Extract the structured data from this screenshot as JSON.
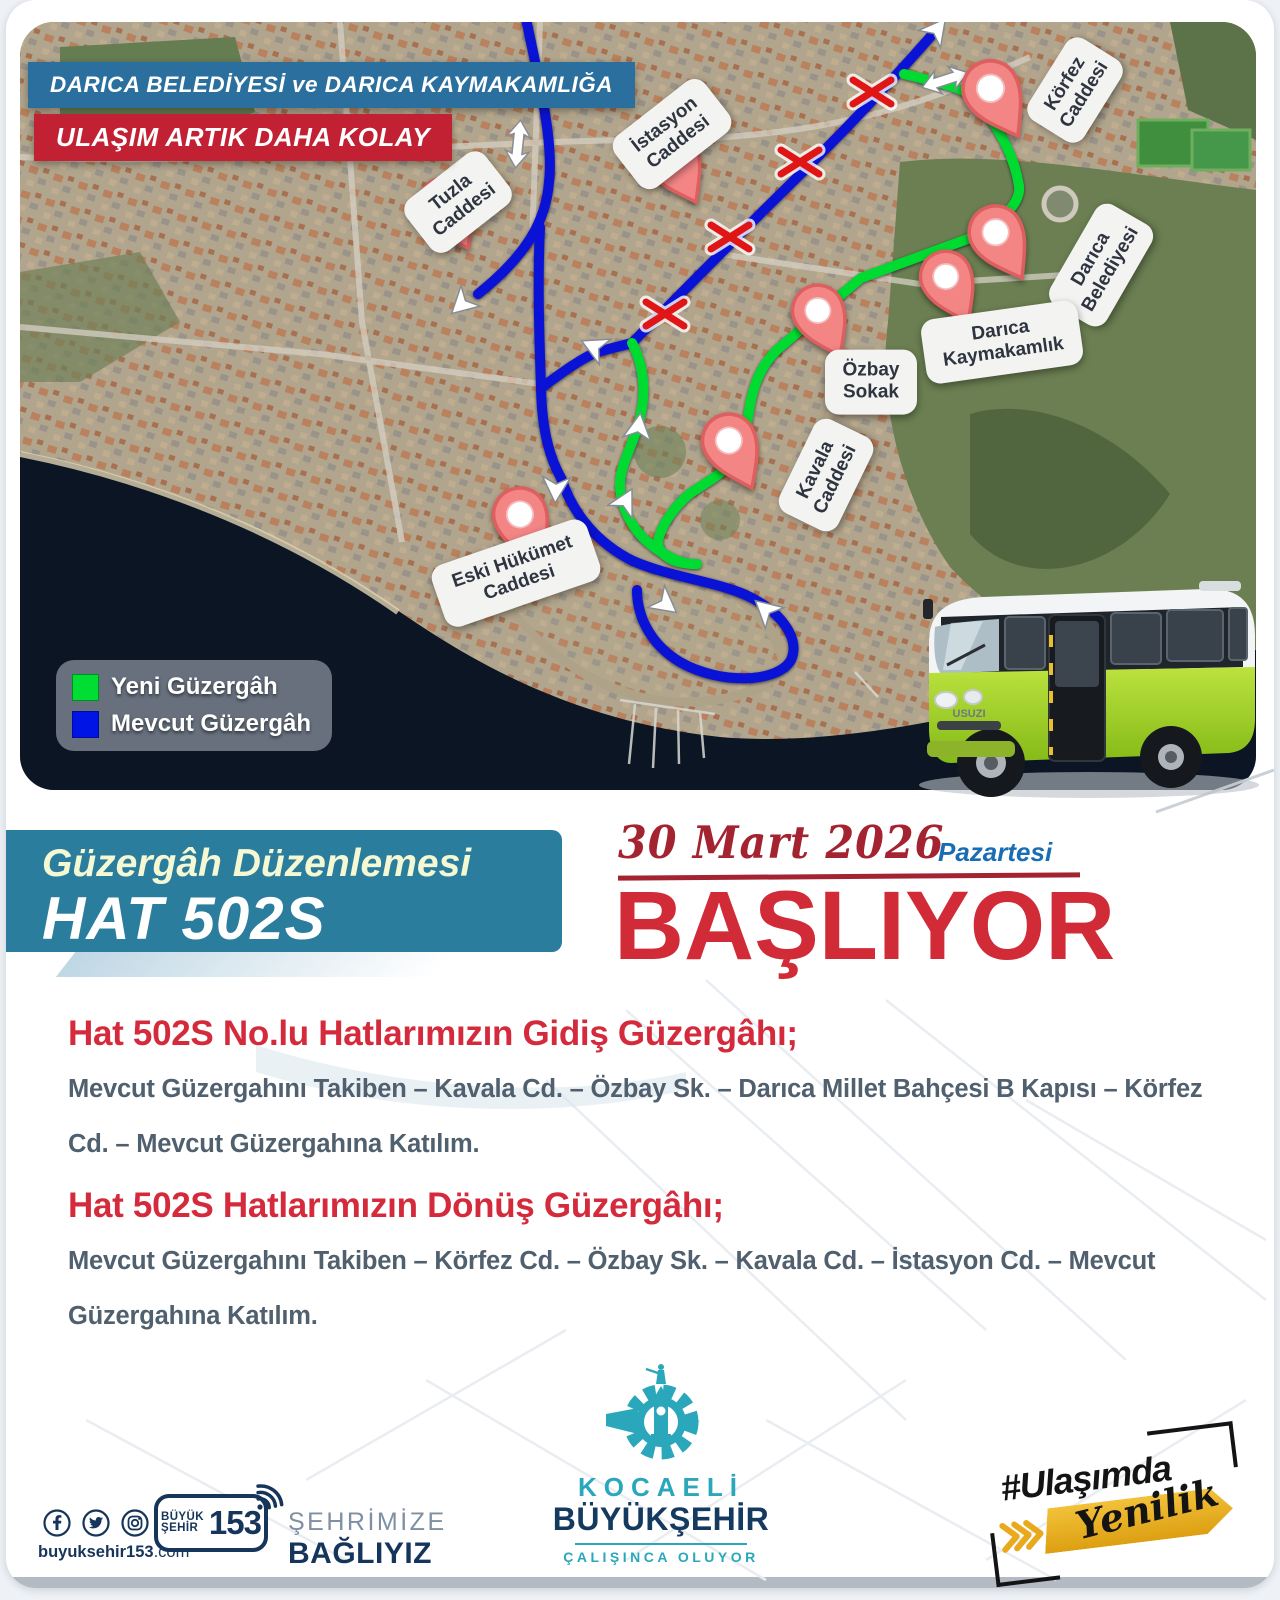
{
  "banners": {
    "municipality": "DARICA BELEDİYESİ ve DARICA KAYMAKAMLIĞA",
    "slogan": "ULAŞIM ARTIK DAHA KOLAY"
  },
  "legend": {
    "items": [
      {
        "label": "Yeni Güzergâh",
        "color": "#00dd33"
      },
      {
        "label": "Mevcut Güzergâh",
        "color": "#0014e6"
      }
    ]
  },
  "map": {
    "pins": [
      {
        "label": "Tuzla Caddesi"
      },
      {
        "label": "İstasyon Caddesi"
      },
      {
        "label": "Körfez Caddesi"
      },
      {
        "label": "Darıca Belediyesi"
      },
      {
        "label": "Darıca Kaymakamlık"
      },
      {
        "label": "Özbay Sokak"
      },
      {
        "label": "Kavala Caddesi"
      },
      {
        "label": "Eski Hükümet Caddesi"
      }
    ],
    "route_colors": {
      "new": "#00dd33",
      "existing": "#0014e6"
    }
  },
  "bus": {
    "brand": "USUZI"
  },
  "band": {
    "title": "Güzergâh Düzenlemesi",
    "line": "HAT 502S"
  },
  "launch": {
    "date": "30 Mart 2026",
    "day": "Pazartesi",
    "action": "BAŞLIYOR"
  },
  "sections": [
    {
      "heading": "Hat 502S No.lu Hatlarımızın Gidiş Güzergâhı;",
      "body": "Mevcut Güzergahını Takiben – Kavala Cd. – Özbay Sk. – Darıca Millet Bahçesi B Kapısı – Körfez Cd. – Mevcut Güzergahına Katılım."
    },
    {
      "heading": "Hat 502S Hatlarımızın Dönüş Güzergâhı;",
      "body": "Mevcut Güzergahını Takiben – Körfez Cd. – Özbay Sk. – Kavala Cd. – İstasyon Cd. – Mevcut Güzergahına Katılım."
    }
  ],
  "footer": {
    "website": {
      "name": "buyuksehir153",
      "tld": ".com"
    },
    "call_center": {
      "word1": "BÜYÜK",
      "word2": "ŞEHİR",
      "number": "153"
    },
    "slogan": {
      "line1": "ŞEHRİMİZE",
      "line2": "BAĞLIYIZ"
    },
    "brand": {
      "city": "KOCAELİ",
      "org": "BÜYÜKŞEHİR",
      "motto": "ÇALIŞINCA OLUYOR"
    },
    "hashtag": {
      "tag": "#Ulaşımda",
      "word": "Yenilik"
    }
  }
}
